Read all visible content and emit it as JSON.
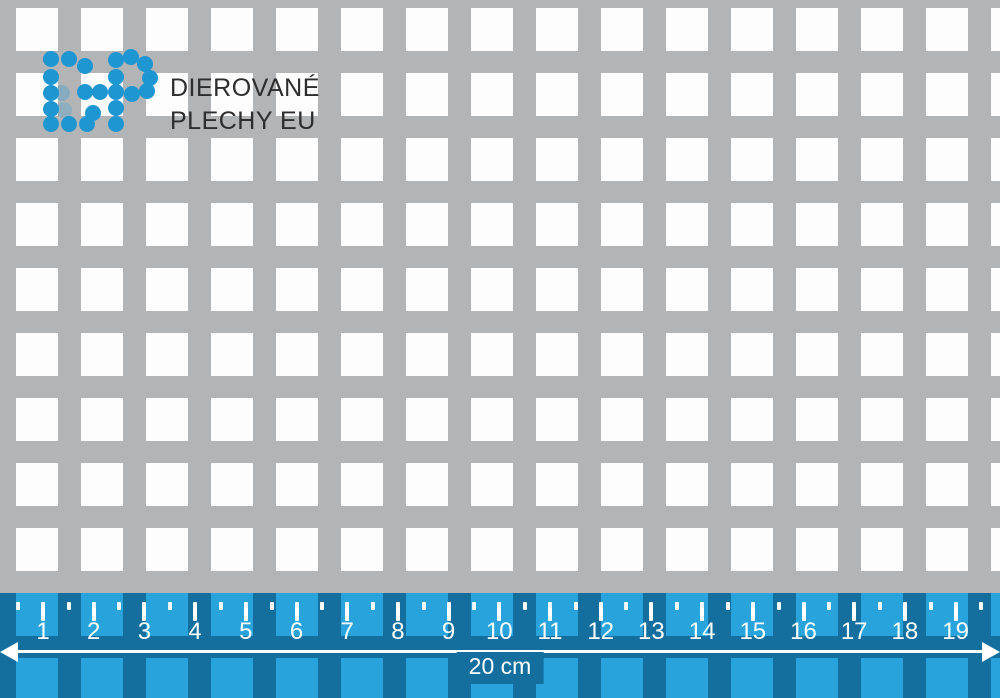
{
  "brand": {
    "logo_letters": "DP",
    "line1": "DIEROVANÉ",
    "line2": "PLECHY EU"
  },
  "ruler": {
    "numbers": [
      "1",
      "2",
      "3",
      "4",
      "5",
      "6",
      "7",
      "8",
      "9",
      "10",
      "11",
      "12",
      "13",
      "14",
      "15",
      "16",
      "17",
      "18",
      "19"
    ],
    "dimension_label": "20 cm"
  },
  "colors": {
    "metal": "#b3b4b6",
    "hole": "#fdfdfe",
    "ruler-bg": "#156f9e",
    "ruler-hole": "#29a3dc",
    "logo-blue": "#1e96d2",
    "text-dark": "#2d2d2d"
  }
}
